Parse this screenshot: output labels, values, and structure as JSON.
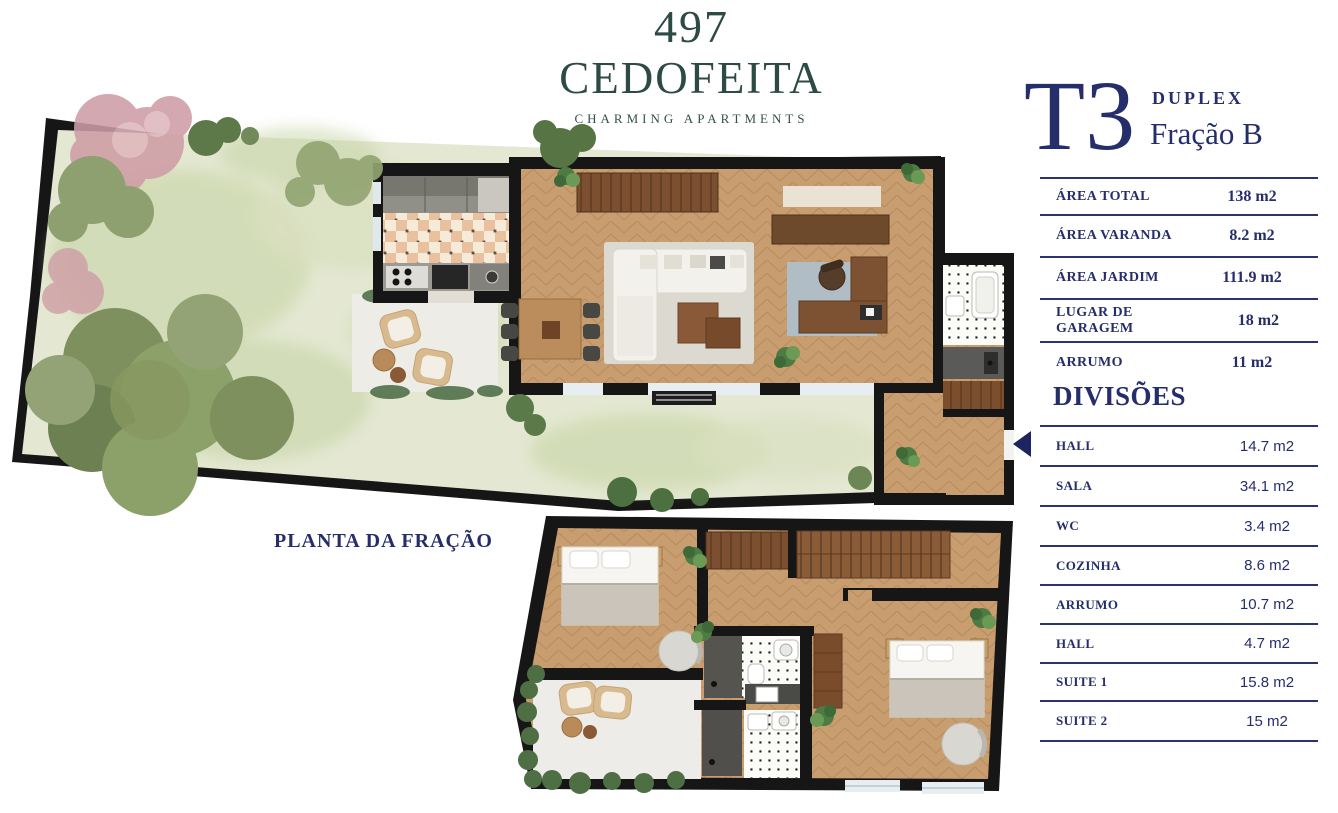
{
  "brand": {
    "number": "497",
    "name": "CEDOFEITA",
    "tagline": "CHARMING APARTMENTS"
  },
  "unit": {
    "typology": "T3",
    "kind": "DUPLEX",
    "fraction": "Fração B"
  },
  "area_table": {
    "rows": [
      {
        "label": "ÁREA TOTAL",
        "value": "138 m2"
      },
      {
        "label": "ÁREA VARANDA",
        "value": "8.2 m2"
      },
      {
        "label": "ÁREA JARDIM",
        "value": "111.9 m2"
      },
      {
        "label": "LUGAR DE GARAGEM",
        "value": "18 m2"
      },
      {
        "label": "ARRUMO",
        "value": "11 m2"
      }
    ]
  },
  "divisions": {
    "title": "DIVISÕES",
    "rows": [
      {
        "label": "HALL",
        "value": "14.7 m2"
      },
      {
        "label": "SALA",
        "value": "34.1 m2"
      },
      {
        "label": "WC",
        "value": "3.4 m2"
      },
      {
        "label": "COZINHA",
        "value": "8.6 m2"
      },
      {
        "label": "ARRUMO",
        "value": "10.7 m2"
      },
      {
        "label": "HALL",
        "value": "4.7 m2"
      },
      {
        "label": "SUITE 1",
        "value": "15.8 m2"
      },
      {
        "label": "SUITE 2",
        "value": "15 m2"
      }
    ]
  },
  "plan": {
    "caption": "PLANTA DA FRAÇÃO"
  },
  "colors": {
    "navy_text": "#252e6b",
    "table_line": "#2b3470",
    "brand_green": "#2d4a45",
    "wall": "#161616",
    "wood_floor": "#c89e70",
    "garden": "#e4e8d2",
    "entrance_arrow": "#1c2560"
  }
}
